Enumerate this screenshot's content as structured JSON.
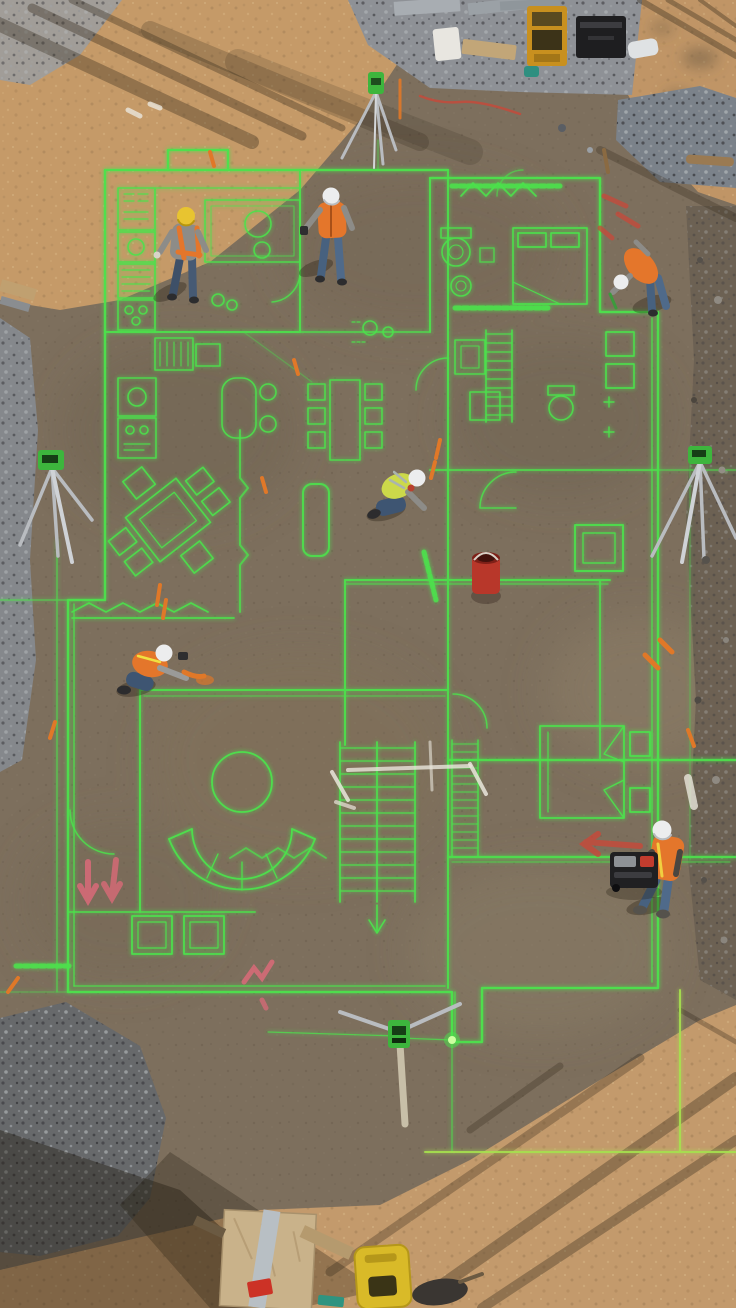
{
  "scene": {
    "description": "Aerial drone view of a residential construction site at golden hour. A full-scale house floor plan is projected in glowing green laser lines onto graded brown dirt. Six construction workers in hi-vis vests and hard hats work across the layout with four green laser-level tripods, survey stakes, spray-paint marks, and equipment staged around the edges.",
    "setting": "construction site, graded dirt pad",
    "view": "top-down aerial, slightly oblique",
    "lighting": "low sun with long diagonal shadows at top and bottom of frame"
  },
  "colors": {
    "dirt_base": "#7d6f5d",
    "dirt_sunlit": "#c59a68",
    "gravel_gray": "#85888c",
    "laser_green": "#4ce24c",
    "laser_soft": "#39c551",
    "laser_bright": "#ccffa0",
    "laser_yellowgreen": "#a6e04e",
    "vest_orange": "#e4762b",
    "vest_yellow": "#ccd94a",
    "helmet_white": "#ecedee",
    "helmet_yellow": "#e8c430",
    "jeans_blue": "#47617f",
    "shirt_gray": "#8d8c88",
    "shadow": "#2e2517",
    "marking_red": "#c8483a",
    "marking_pink": "#e06a7a",
    "marking_orange": "#e07828",
    "chalk_white": "#eae6dc",
    "plywood_tan": "#c9b28a",
    "case_yellow": "#d9ba28",
    "toolbox_black": "#1e1e20",
    "stand_yellow": "#c8901f",
    "tripod_gray": "#b9bcc0",
    "laser_head_green": "#3db53d"
  },
  "floor_plan": {
    "type": "laser-projected residential floor plan",
    "rooms": [
      "kitchen",
      "dining area",
      "hallway",
      "bathroom",
      "upper bedroom",
      "ensuite",
      "living room",
      "lower bedroom",
      "walk-in closet",
      "staircase"
    ],
    "symbols": [
      "kitchen island with cooktop circles",
      "counter appliance boxes",
      "rotated dining table with chairs",
      "second dining table with six chairs",
      "toilet and sink fixtures",
      "double bed with pillows (upper)",
      "double bed with corner flourishes (lower)",
      "curved sectional sofa",
      "round coffee table",
      "stair treads with direction arrow",
      "closet hatch lines",
      "door swing arcs",
      "zigzag window symbols",
      "stencil text labels (illegible)"
    ]
  },
  "workers": [
    {
      "id": 1,
      "hardhat": "yellow",
      "vest": "orange straps over gray shirt",
      "pants": "blue jeans",
      "pose": "standing, looking down",
      "location": "kitchen, upper left"
    },
    {
      "id": 2,
      "hardhat": "white",
      "vest": "orange",
      "pants": "blue jeans",
      "pose": "standing, checking handheld device",
      "location": "top center hallway"
    },
    {
      "id": 3,
      "hardhat": "white",
      "vest": "orange",
      "pants": "blue jeans",
      "pose": "bending over at plan edge",
      "location": "upper right"
    },
    {
      "id": 4,
      "hardhat": "white",
      "vest": "yellow-green",
      "pants": "blue jeans",
      "pose": "kneeling, marking floor",
      "location": "center"
    },
    {
      "id": 5,
      "hardhat": "white",
      "vest": "orange",
      "pants": "blue jeans",
      "pose": "kneeling, spray painting",
      "location": "middle left"
    },
    {
      "id": 6,
      "hardhat": "white",
      "vest": "orange",
      "pants": "blue jeans",
      "pose": "leaning over generator",
      "location": "lower right"
    }
  ],
  "equipment": {
    "tripod_lasers": [
      {
        "id": "T1",
        "location": "top center"
      },
      {
        "id": "T2",
        "location": "middle left"
      },
      {
        "id": "T3",
        "location": "middle right"
      },
      {
        "id": "T4",
        "location": "bottom center, beams visible"
      }
    ],
    "top_area": [
      "gray metal panels",
      "yellow tool stand",
      "black toolbox crate",
      "white foam block",
      "lumber piece",
      "white plastic bag",
      "teal bottle",
      "red extension cord"
    ],
    "bottom_area": [
      "plywood sheet with metal strip",
      "yellow laser case",
      "red hand tool",
      "teal hand tool",
      "dark tool pile",
      "lumber offcuts"
    ],
    "other": [
      "black portable generator beside worker 6",
      "red bucket near center",
      "brown pipe at right",
      "wood planks at left edge"
    ]
  },
  "ground_markings": [
    "orange survey whisker stakes",
    "pink spray arrows",
    "red spray arrow and dashes",
    "white chalk lines",
    "green stencil labels"
  ],
  "terrain": [
    "gravel strip across top",
    "gravel pile at right",
    "gravel pile bottom left",
    "sunlit sand at top and bottom",
    "long diagonal pole shadows"
  ]
}
